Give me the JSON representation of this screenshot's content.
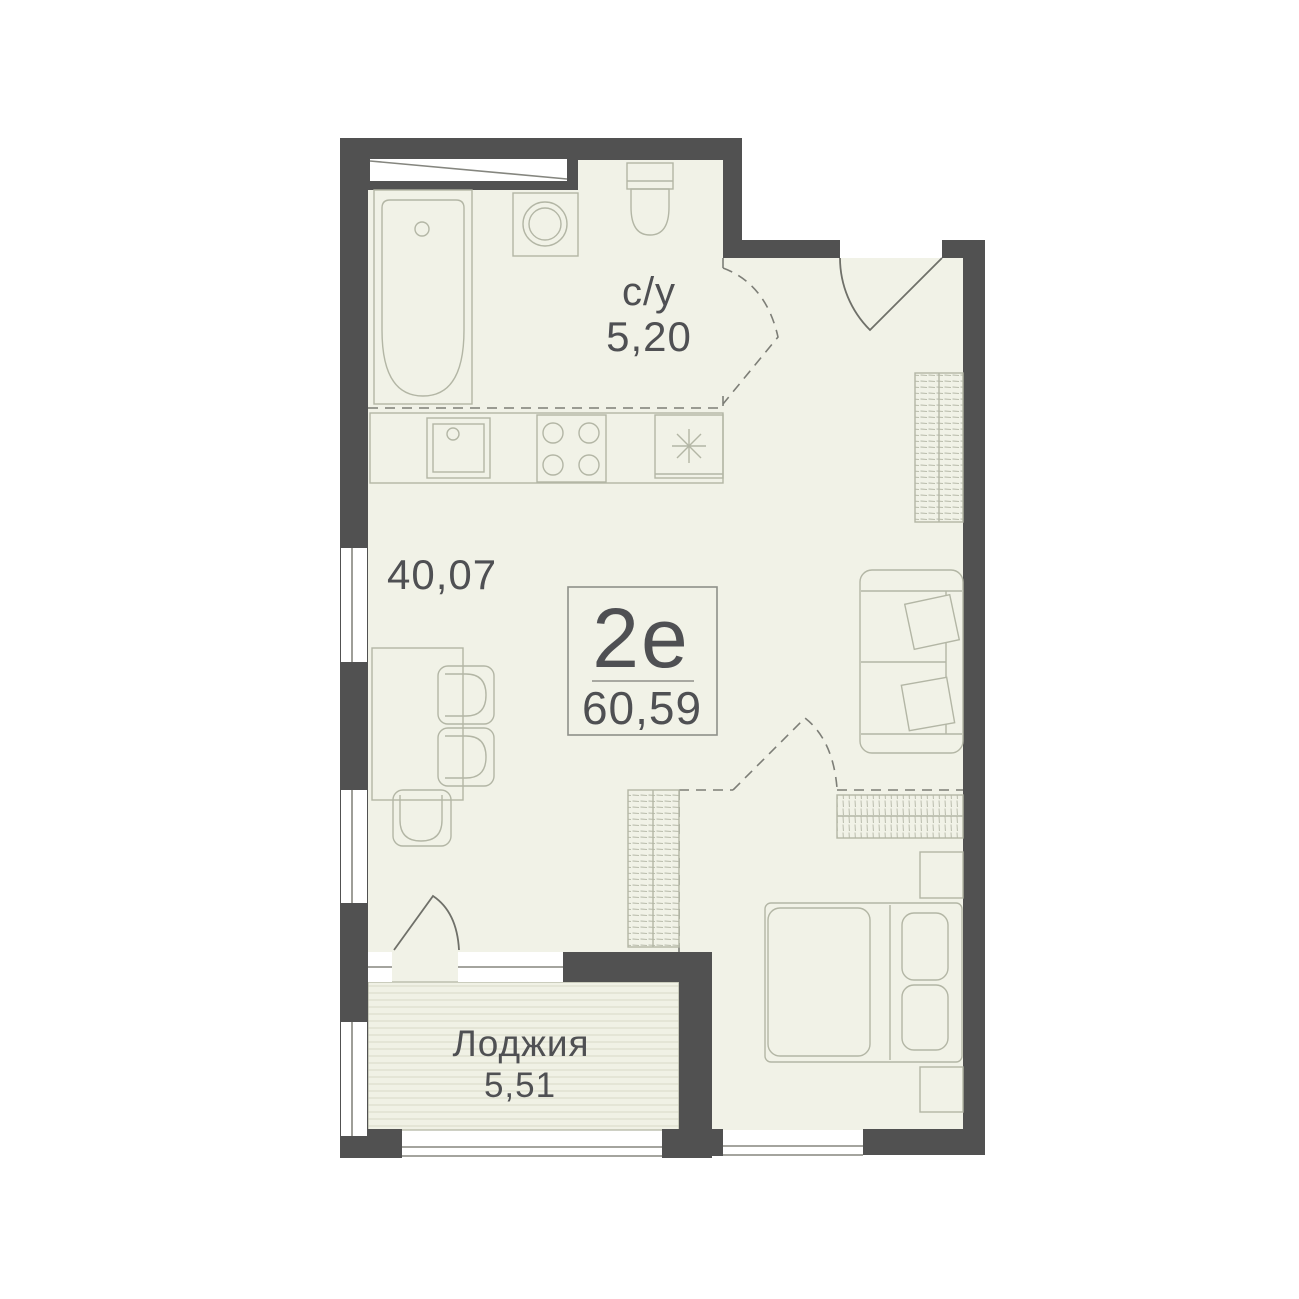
{
  "plan": {
    "unit": {
      "type_label": "2е",
      "total_area": "60,59"
    },
    "rooms": {
      "bathroom": {
        "label": "с/у",
        "area": "5,20"
      },
      "living": {
        "area": "40,07"
      },
      "loggia": {
        "label": "Лоджия",
        "area": "5,51"
      }
    },
    "palette": {
      "wall": "#515151",
      "floor": "#f1f2e7",
      "furniture_outline": "#b3b6a5",
      "door_outline": "#6f7069",
      "dashed_line": "#7d7e77",
      "text": "#4f5053",
      "loggia_stripe": "#dcddcb",
      "background": "#ffffff"
    },
    "furniture_icons": [
      "bathtub-icon",
      "washing-machine-icon",
      "toilet-icon",
      "kitchen-sink-icon",
      "stove-icon",
      "fridge-icon",
      "dining-table-icon",
      "chair-icon",
      "wardrobe-icon",
      "sofa-icon",
      "bed-icon",
      "nightstand-icon"
    ]
  }
}
